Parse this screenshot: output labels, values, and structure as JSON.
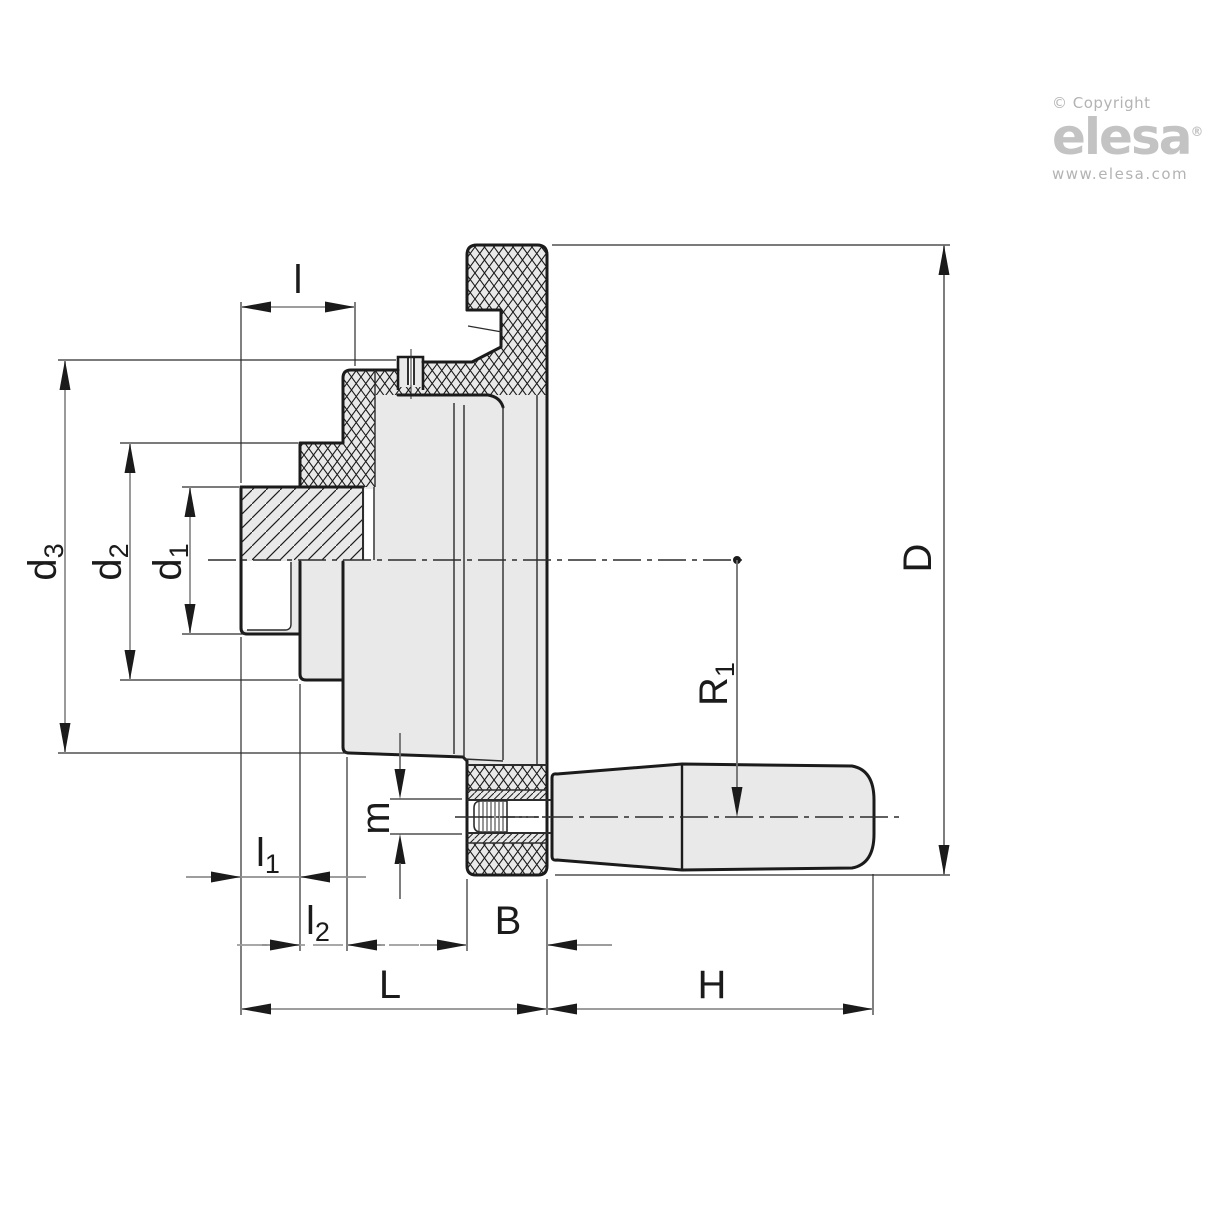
{
  "drawing_title": "handwheel-with-revolving-handle-cross-section",
  "dimension_labels": {
    "l": {
      "base": "l",
      "sub": ""
    },
    "d3": {
      "base": "d",
      "sub": "3"
    },
    "d2": {
      "base": "d",
      "sub": "2"
    },
    "d1": {
      "base": "d",
      "sub": "1"
    },
    "D": {
      "base": "D",
      "sub": ""
    },
    "R1": {
      "base": "R",
      "sub": "1"
    },
    "m": {
      "base": "m",
      "sub": ""
    },
    "l1": {
      "base": "l",
      "sub": "1"
    },
    "l2": {
      "base": "l",
      "sub": "2"
    },
    "B": {
      "base": "B",
      "sub": ""
    },
    "L": {
      "base": "L",
      "sub": ""
    },
    "H": {
      "base": "H",
      "sub": ""
    }
  },
  "branding": {
    "copyright": "© Copyright",
    "logo_text": "elesa",
    "registered_mark": "®",
    "website": "www.elesa.com"
  },
  "colors": {
    "part_fill": "#e9e9e9",
    "outline": "#1b1b1b",
    "dimension_line": "#8f8f8f",
    "extension_line": "#2c2c2c",
    "logo_gray": "#c3c3c3"
  }
}
